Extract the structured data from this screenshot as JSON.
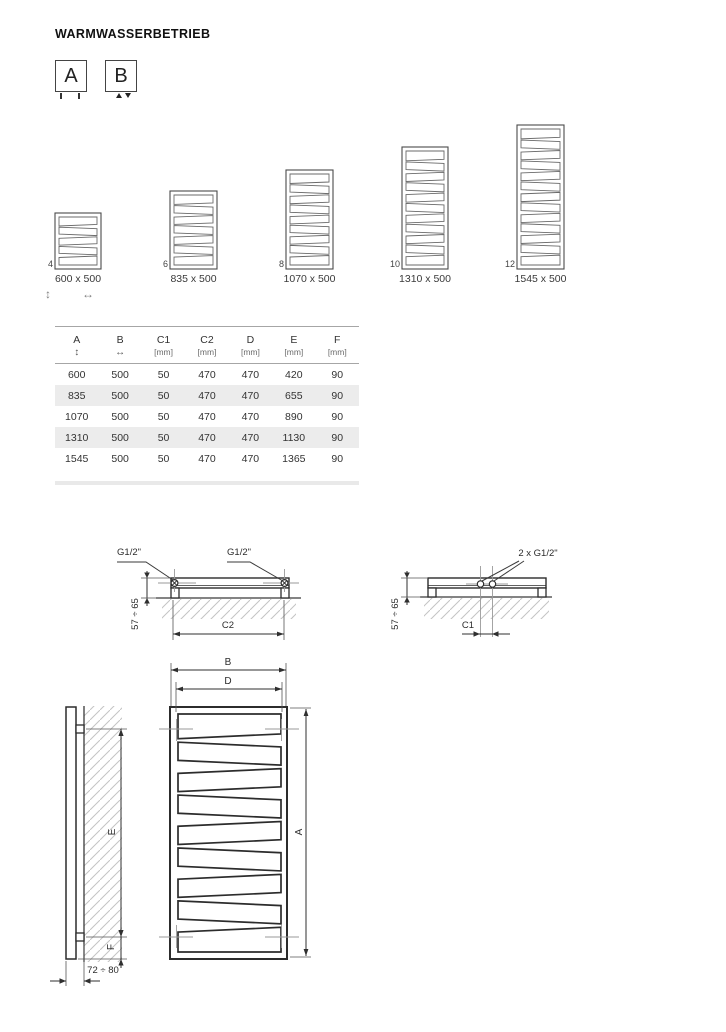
{
  "title": "WARMWASSERBETRIEB",
  "variants": [
    {
      "label": "A",
      "marker": "bottom-tick-connections"
    },
    {
      "label": "B",
      "marker": "center-triangle-connections"
    }
  ],
  "radiators": [
    {
      "code": "4",
      "size": "600 x 500",
      "slats": 5
    },
    {
      "code": "6",
      "size": "835 x 500",
      "slats": 7
    },
    {
      "code": "8",
      "size": "1070 x 500",
      "slats": 9
    },
    {
      "code": "10",
      "size": "1310 x 500",
      "slats": 11
    },
    {
      "code": "12",
      "size": "1545 x 500",
      "slats": 13
    }
  ],
  "axis_icons": {
    "vertical": "↕",
    "horizontal": "↔"
  },
  "table": {
    "columns": [
      {
        "label": "A",
        "sub": "↕"
      },
      {
        "label": "B",
        "sub": "↔"
      },
      {
        "label": "C1",
        "sub": "[mm]"
      },
      {
        "label": "C2",
        "sub": "[mm]"
      },
      {
        "label": "D",
        "sub": "[mm]"
      },
      {
        "label": "E",
        "sub": "[mm]"
      },
      {
        "label": "F",
        "sub": "[mm]"
      }
    ],
    "rows": [
      [
        "600",
        "500",
        "50",
        "470",
        "470",
        "420",
        "90"
      ],
      [
        "835",
        "500",
        "50",
        "470",
        "470",
        "655",
        "90"
      ],
      [
        "1070",
        "500",
        "50",
        "470",
        "470",
        "890",
        "90"
      ],
      [
        "1310",
        "500",
        "50",
        "470",
        "470",
        "1130",
        "90"
      ],
      [
        "1545",
        "500",
        "50",
        "470",
        "470",
        "1365",
        "90"
      ]
    ]
  },
  "drawings": {
    "connection_side_left": "G1/2\"",
    "connection_side_right": "G1/2\"",
    "connection_center": "2 x G1/2\"",
    "wall_distance_left": "57 ÷ 65",
    "wall_distance_right": "57 ÷ 65",
    "c2_label": "C2",
    "c1_label": "C1",
    "front_width_outer": "B",
    "front_width_inner": "D",
    "front_height": "A",
    "side_upper_span": "E",
    "side_lower_span": "F",
    "side_depth": "72 ÷ 80"
  }
}
